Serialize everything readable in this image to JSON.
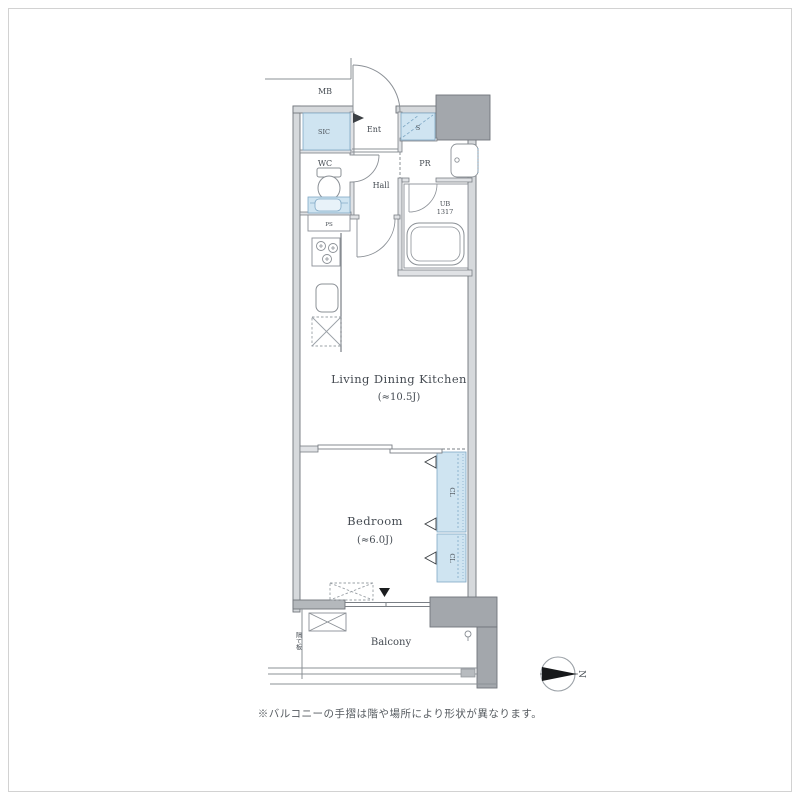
{
  "rooms": {
    "ldk": {
      "label": "Living Dining Kitchen",
      "area": "(≈10.5J)"
    },
    "bedroom": {
      "label": "Bedroom",
      "area": "(≈6.0J)"
    },
    "balcony": {
      "label": "Balcony"
    },
    "hall": {
      "label": "Hall"
    },
    "wc": {
      "label": "WC"
    },
    "entrance": {
      "label": "Ent"
    },
    "shoe_closet": {
      "label": "SIC"
    },
    "storage": {
      "label": "S"
    },
    "powder_room": {
      "label": "PR"
    },
    "unit_bath": {
      "label": "UB",
      "size": "1317"
    },
    "closet_upper": {
      "label": "CL"
    },
    "closet_lower": {
      "label": "CL"
    },
    "meter_box": {
      "label": "MB"
    },
    "pipe_space": {
      "label": "PS"
    }
  },
  "balcony_partition": "隔て板",
  "compass": {
    "north_label": "N"
  },
  "note": "※バルコニーの手摺は階や場所により形状が異なります。",
  "colors": {
    "closet_fill": "#cfe4f1",
    "closet_line": "#7fa8c5",
    "wall_fill": "#d6d9dc",
    "solid_wall_fill": "#a3a7ac",
    "dark_wall_fill": "#b4b8bc",
    "line": "#70757b",
    "text": "#454b52"
  }
}
